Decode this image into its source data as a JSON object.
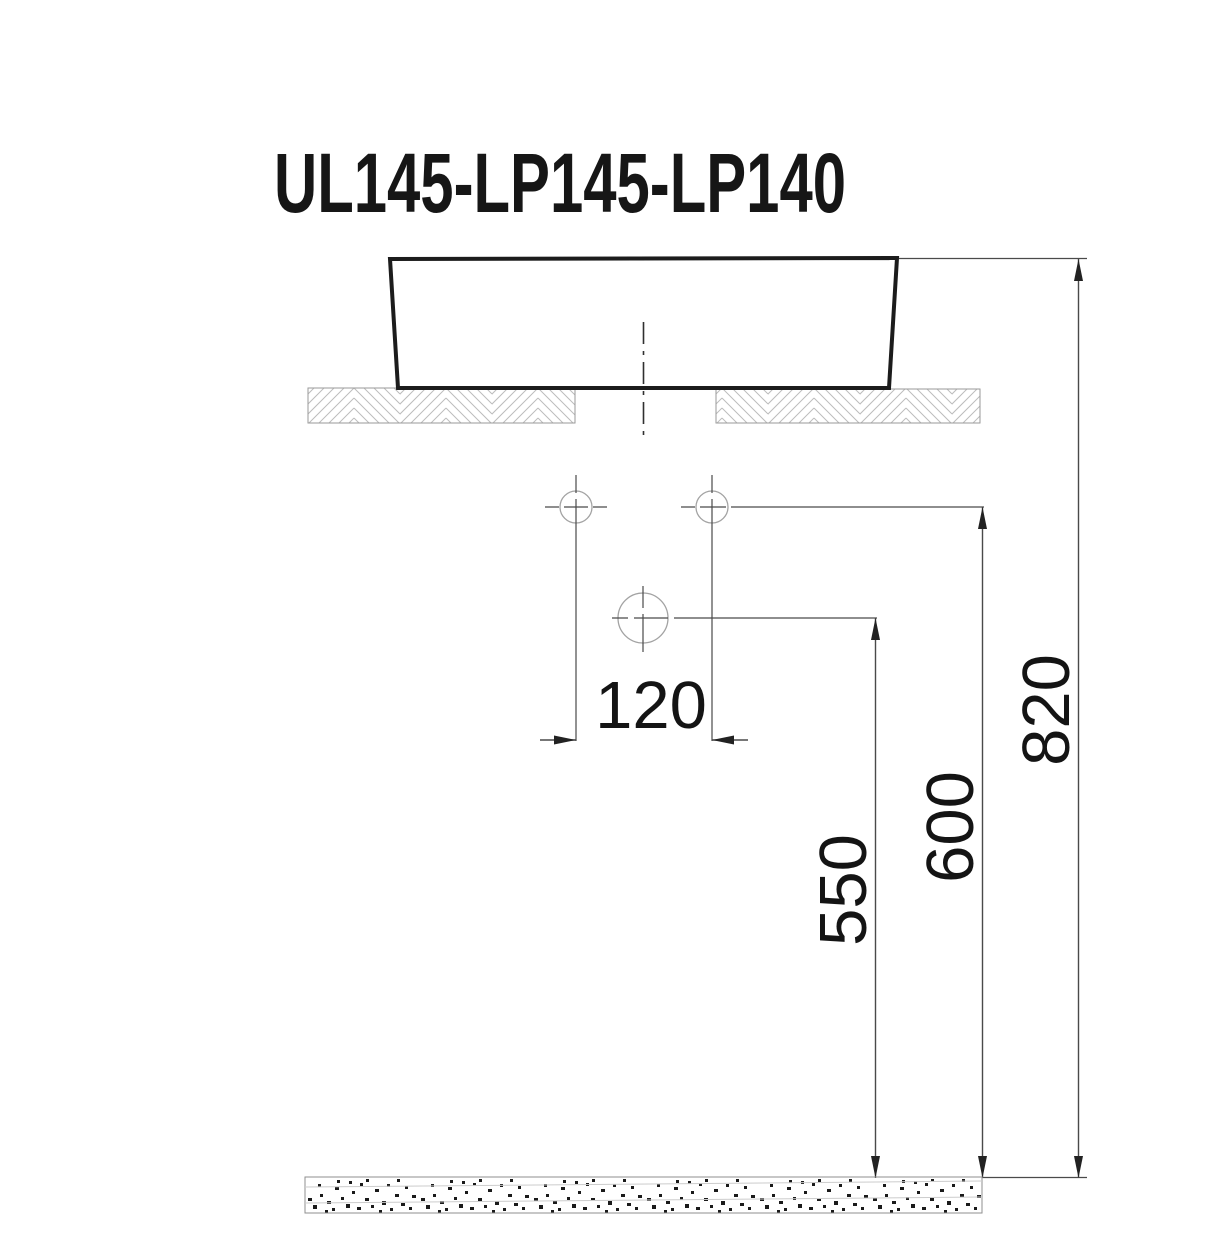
{
  "drawing": {
    "title": "UL145-LP145-LP140",
    "dimensions": {
      "faucet_hole_spacing": "120",
      "drain_outlet_height": "550",
      "supply_outlet_height": "600",
      "basin_rim_height": "820"
    },
    "colors": {
      "line": "#1c1c1c",
      "dim_line": "#4a4a4a",
      "hatch": "#bcbcbc",
      "text": "#141414",
      "background": "#ffffff"
    }
  }
}
